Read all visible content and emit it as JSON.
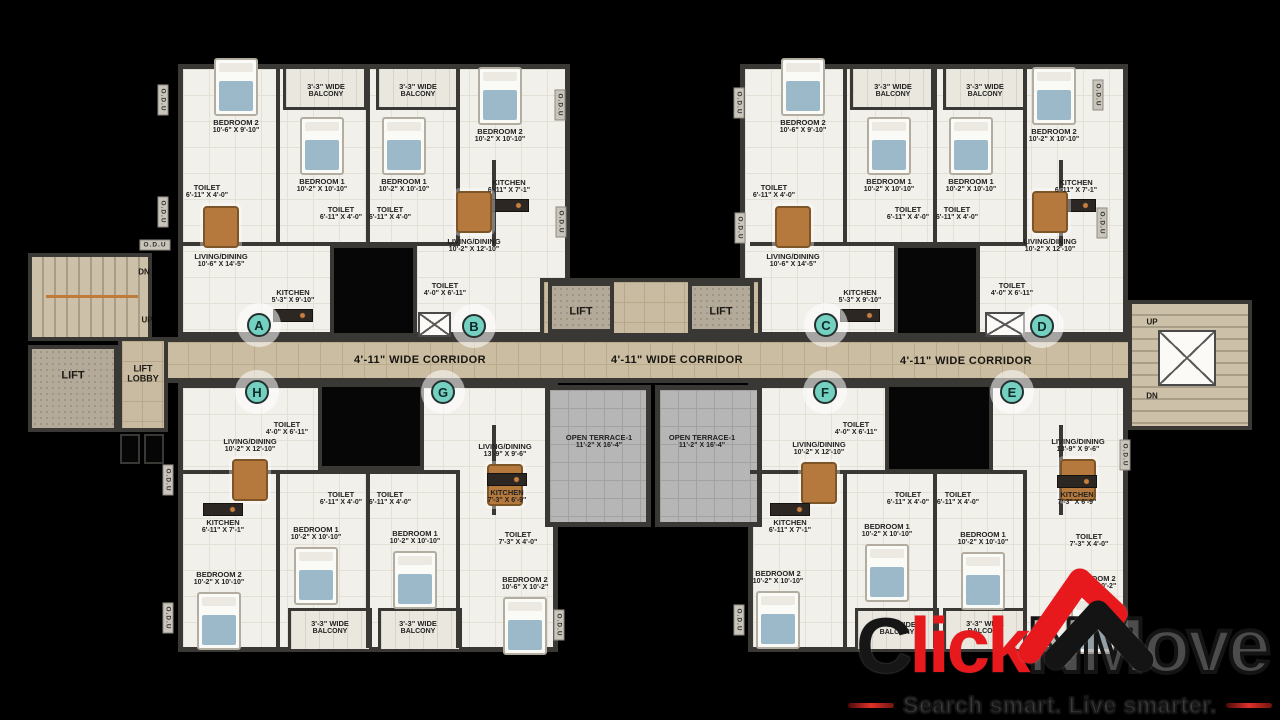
{
  "branding": {
    "logo_c": "C",
    "logo_lick": "lick",
    "logo_nmove": "NMove",
    "tagline": "Search smart. Live smarter.",
    "logo_red": "#e8191c",
    "logo_black": "#141414"
  },
  "colors": {
    "wall": "#3a3835",
    "floor": "#f2f0ea",
    "corridor": "#cbbda2",
    "terrace": "#b6b6b6",
    "lift_floor": "#b4aa9a",
    "unit_marker": "#74d0c0",
    "furniture_wood": "#b5793d",
    "bed_blue": "#9cb9ca"
  },
  "plan": {
    "corridor_labels": [
      {
        "text": "4'-11\" WIDE CORRIDOR",
        "x": 420,
        "y": 360
      },
      {
        "text": "4'-11\" WIDE CORRIDOR",
        "x": 677,
        "y": 360
      },
      {
        "text": "4'-11\" WIDE CORRIDOR",
        "x": 966,
        "y": 361
      }
    ],
    "core_labels": [
      {
        "text": "LIFT",
        "x": 73,
        "y": 376,
        "size": 11
      },
      {
        "text": "LIFT LOBBY",
        "x": 143,
        "y": 374,
        "size": 9,
        "w": 44
      },
      {
        "text": "LIFT",
        "x": 581,
        "y": 312,
        "size": 11
      },
      {
        "text": "LIFT",
        "x": 721,
        "y": 312,
        "size": 11
      },
      {
        "text": "DN",
        "x": 144,
        "y": 272,
        "size": 8
      },
      {
        "text": "UP",
        "x": 147,
        "y": 320,
        "size": 8
      },
      {
        "text": "UP",
        "x": 1152,
        "y": 322,
        "size": 8
      },
      {
        "text": "DN",
        "x": 1152,
        "y": 396,
        "size": 8
      }
    ],
    "odu_labels": [
      {
        "text": "O.D.U",
        "x": 163,
        "y": 100
      },
      {
        "text": "O.D.U",
        "x": 163,
        "y": 212
      },
      {
        "text": "O.D.U",
        "x": 155,
        "y": 245,
        "horizontal": true
      },
      {
        "text": "O.D.U",
        "x": 560,
        "y": 105
      },
      {
        "text": "O.D.U",
        "x": 561,
        "y": 222
      },
      {
        "text": "O.D.U",
        "x": 739,
        "y": 103
      },
      {
        "text": "O.D.U",
        "x": 740,
        "y": 228
      },
      {
        "text": "O.D.U",
        "x": 1098,
        "y": 95
      },
      {
        "text": "O.D.U",
        "x": 1102,
        "y": 223
      },
      {
        "text": "O.D.U",
        "x": 168,
        "y": 480
      },
      {
        "text": "O.D.U",
        "x": 168,
        "y": 618
      },
      {
        "text": "O.D.U",
        "x": 559,
        "y": 625
      },
      {
        "text": "O.D.U",
        "x": 739,
        "y": 620
      },
      {
        "text": "O.D.U",
        "x": 1125,
        "y": 455
      }
    ],
    "units": [
      {
        "label": "A",
        "x": 259,
        "y": 325
      },
      {
        "label": "B",
        "x": 474,
        "y": 326
      },
      {
        "label": "C",
        "x": 826,
        "y": 325
      },
      {
        "label": "D",
        "x": 1042,
        "y": 326
      },
      {
        "label": "H",
        "x": 257,
        "y": 392
      },
      {
        "label": "G",
        "x": 443,
        "y": 392
      },
      {
        "label": "F",
        "x": 825,
        "y": 392
      },
      {
        "label": "E",
        "x": 1012,
        "y": 392
      }
    ],
    "rooms": [
      {
        "line1": "BEDROOM 2",
        "line2": "10'-6\" X 9'-10\"",
        "x": 236,
        "y": 127,
        "type": "bedroom"
      },
      {
        "line1": "3'-3\" WIDE",
        "line2": "BALCONY",
        "x": 326,
        "y": 91,
        "type": "balcony"
      },
      {
        "line1": "3'-3\" WIDE",
        "line2": "BALCONY",
        "x": 418,
        "y": 91,
        "type": "balcony"
      },
      {
        "line1": "BEDROOM 1",
        "line2": "10'-2\" X 10'-10\"",
        "x": 322,
        "y": 186,
        "type": "bedroom"
      },
      {
        "line1": "BEDROOM 1",
        "line2": "10'-2\" X 10'-10\"",
        "x": 404,
        "y": 186,
        "type": "bedroom"
      },
      {
        "line1": "BEDROOM 2",
        "line2": "10'-2\" X 10'-10\"",
        "x": 500,
        "y": 136,
        "type": "bedroom"
      },
      {
        "line1": "TOILET",
        "line2": "6'-11\" X 4'-0\"",
        "x": 207,
        "y": 192,
        "type": "toilet"
      },
      {
        "line1": "TOILET",
        "line2": "6'-11\" X 4'-0\"",
        "x": 341,
        "y": 214,
        "type": "toilet"
      },
      {
        "line1": "TOILET",
        "line2": "6'-11\" X 4'-0\"",
        "x": 390,
        "y": 214,
        "type": "toilet"
      },
      {
        "line1": "KITCHEN",
        "line2": "6'-11\" X 7'-1\"",
        "x": 509,
        "y": 187,
        "type": "kitchen"
      },
      {
        "line1": "LIVING/DINING",
        "line2": "10'-6\" X 14'-5\"",
        "x": 221,
        "y": 261,
        "type": "living"
      },
      {
        "line1": "LIVING/DINING",
        "line2": "10'-2\" X 12'-10\"",
        "x": 474,
        "y": 246,
        "type": "living"
      },
      {
        "line1": "KITCHEN",
        "line2": "5'-3\" X 9'-10\"",
        "x": 293,
        "y": 297,
        "type": "kitchen"
      },
      {
        "line1": "TOILET",
        "line2": "4'-0\" X 6'-11\"",
        "x": 445,
        "y": 290,
        "type": "toilet"
      },
      {
        "line1": "BEDROOM 2",
        "line2": "10'-6\" X 9'-10\"",
        "x": 803,
        "y": 127,
        "type": "bedroom"
      },
      {
        "line1": "3'-3\" WIDE",
        "line2": "BALCONY",
        "x": 893,
        "y": 91,
        "type": "balcony"
      },
      {
        "line1": "3'-3\" WIDE",
        "line2": "BALCONY",
        "x": 985,
        "y": 91,
        "type": "balcony"
      },
      {
        "line1": "BEDROOM 1",
        "line2": "10'-2\" X 10'-10\"",
        "x": 889,
        "y": 186,
        "type": "bedroom"
      },
      {
        "line1": "BEDROOM 1",
        "line2": "10'-2\" X 10'-10\"",
        "x": 971,
        "y": 186,
        "type": "bedroom"
      },
      {
        "line1": "BEDROOM 2",
        "line2": "10'-2\" X 10'-10\"",
        "x": 1054,
        "y": 136,
        "type": "bedroom"
      },
      {
        "line1": "TOILET",
        "line2": "6'-11\" X 4'-0\"",
        "x": 774,
        "y": 192,
        "type": "toilet"
      },
      {
        "line1": "TOILET",
        "line2": "6'-11\" X 4'-0\"",
        "x": 908,
        "y": 214,
        "type": "toilet"
      },
      {
        "line1": "TOILET",
        "line2": "6'-11\" X 4'-0\"",
        "x": 957,
        "y": 214,
        "type": "toilet"
      },
      {
        "line1": "KITCHEN",
        "line2": "6'-11\" X 7'-1\"",
        "x": 1076,
        "y": 187,
        "type": "kitchen"
      },
      {
        "line1": "LIVING/DINING",
        "line2": "10'-6\" X 14'-5\"",
        "x": 793,
        "y": 261,
        "type": "living"
      },
      {
        "line1": "LIVING/DINING",
        "line2": "10'-2\" X 12'-10\"",
        "x": 1050,
        "y": 246,
        "type": "living"
      },
      {
        "line1": "KITCHEN",
        "line2": "5'-3\" X 9'-10\"",
        "x": 860,
        "y": 297,
        "type": "kitchen"
      },
      {
        "line1": "TOILET",
        "line2": "4'-0\" X 6'-11\"",
        "x": 1012,
        "y": 290,
        "type": "toilet"
      },
      {
        "line1": "LIVING/DINING",
        "line2": "10'-2\" X 12'-10\"",
        "x": 250,
        "y": 446,
        "type": "living"
      },
      {
        "line1": "TOILET",
        "line2": "4'-0\" X 6'-11\"",
        "x": 287,
        "y": 429,
        "type": "toilet"
      },
      {
        "line1": "TOILET",
        "line2": "6'-11\" X 4'-0\"",
        "x": 341,
        "y": 499,
        "type": "toilet"
      },
      {
        "line1": "TOILET",
        "line2": "6'-11\" X 4'-0\"",
        "x": 390,
        "y": 499,
        "type": "toilet"
      },
      {
        "line1": "KITCHEN",
        "line2": "6'-11\" X 7'-1\"",
        "x": 223,
        "y": 527,
        "type": "kitchen"
      },
      {
        "line1": "BEDROOM 2",
        "line2": "10'-2\" X 10'-10\"",
        "x": 219,
        "y": 579,
        "type": "bedroom"
      },
      {
        "line1": "BEDROOM 1",
        "line2": "10'-2\" X 10'-10\"",
        "x": 316,
        "y": 534,
        "type": "bedroom"
      },
      {
        "line1": "BEDROOM 1",
        "line2": "10'-2\" X 10'-10\"",
        "x": 415,
        "y": 538,
        "type": "bedroom"
      },
      {
        "line1": "3'-3\" WIDE",
        "line2": "BALCONY",
        "x": 330,
        "y": 628,
        "type": "balcony"
      },
      {
        "line1": "3'-3\" WIDE",
        "line2": "BALCONY",
        "x": 418,
        "y": 628,
        "type": "balcony"
      },
      {
        "line1": "LIVING/DINING",
        "line2": "13'-9\" X 9'-6\"",
        "x": 505,
        "y": 451,
        "type": "living"
      },
      {
        "line1": "KITCHEN",
        "line2": "7'-3\" X 6'-9\"",
        "x": 507,
        "y": 497,
        "type": "kitchen"
      },
      {
        "line1": "TOILET",
        "line2": "7'-3\" X 4'-0\"",
        "x": 518,
        "y": 539,
        "type": "toilet"
      },
      {
        "line1": "BEDROOM 2",
        "line2": "10'-6\" X 10'-2\"",
        "x": 525,
        "y": 584,
        "type": "bedroom"
      },
      {
        "line1": "OPEN TERRACE-1",
        "line2": "11'-2\" X 16'-4\"",
        "x": 599,
        "y": 442,
        "type": "terrace"
      },
      {
        "line1": "OPEN TERRACE-1",
        "line2": "11'-2\" X 16'-4\"",
        "x": 702,
        "y": 442,
        "type": "terrace"
      },
      {
        "line1": "LIVING/DINING",
        "line2": "10'-2\" X 12'-10\"",
        "x": 819,
        "y": 449,
        "type": "living"
      },
      {
        "line1": "TOILET",
        "line2": "4'-0\" X 6'-11\"",
        "x": 856,
        "y": 429,
        "type": "toilet"
      },
      {
        "line1": "TOILET",
        "line2": "6'-11\" X 4'-0\"",
        "x": 908,
        "y": 499,
        "type": "toilet"
      },
      {
        "line1": "TOILET",
        "line2": "6'-11\" X 4'-0\"",
        "x": 958,
        "y": 499,
        "type": "toilet"
      },
      {
        "line1": "KITCHEN",
        "line2": "6'-11\" X 7'-1\"",
        "x": 790,
        "y": 527,
        "type": "kitchen"
      },
      {
        "line1": "BEDROOM 2",
        "line2": "10'-2\" X 10'-10\"",
        "x": 778,
        "y": 578,
        "type": "bedroom"
      },
      {
        "line1": "BEDROOM 1",
        "line2": "10'-2\" X 10'-10\"",
        "x": 887,
        "y": 531,
        "type": "bedroom"
      },
      {
        "line1": "BEDROOM 1",
        "line2": "10'-2\" X 10'-10\"",
        "x": 983,
        "y": 539,
        "type": "bedroom"
      },
      {
        "line1": "LIVING/DINING",
        "line2": "13'-9\" X 9'-6\"",
        "x": 1078,
        "y": 446,
        "type": "living"
      },
      {
        "line1": "KITCHEN",
        "line2": "7'-3\" X 6'-9\"",
        "x": 1077,
        "y": 499,
        "type": "kitchen"
      },
      {
        "line1": "TOILET",
        "line2": "7'-3\" X 4'-0\"",
        "x": 1089,
        "y": 541,
        "type": "toilet"
      },
      {
        "line1": "BEDROOM 2",
        "line2": "10'-6\" X 10'-2\"",
        "x": 1093,
        "y": 583,
        "type": "bedroom"
      },
      {
        "line1": "3'-3\" WIDE",
        "line2": "BALCONY",
        "x": 897,
        "y": 629,
        "type": "balcony"
      },
      {
        "line1": "3'-3\" WIDE",
        "line2": "BALCONY",
        "x": 985,
        "y": 628,
        "type": "balcony"
      }
    ]
  }
}
